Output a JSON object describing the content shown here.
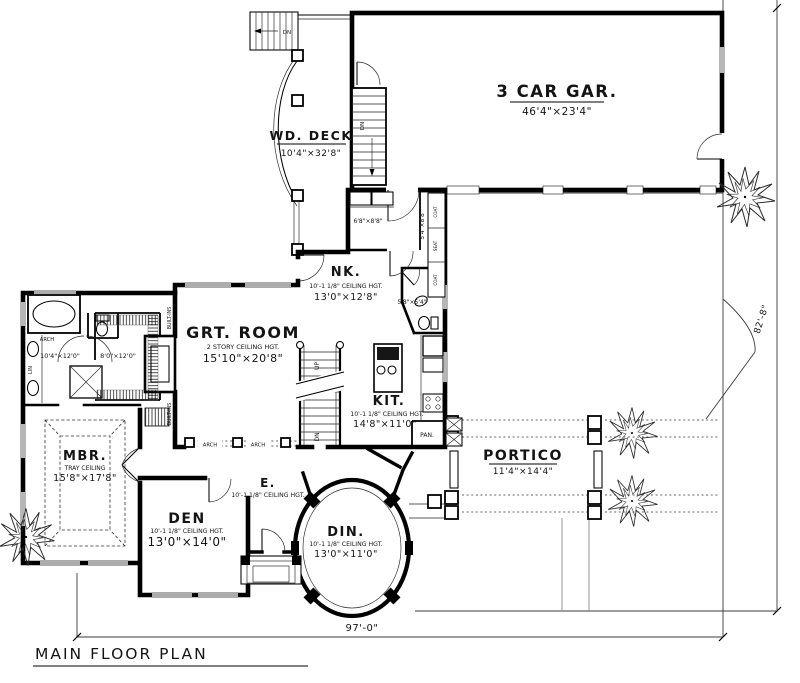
{
  "plan": {
    "title": "MAIN FLOOR PLAN"
  },
  "dimensions": {
    "width": "97'-0\"",
    "depth": "82'-8\""
  },
  "rooms": {
    "garage": {
      "name": "3 CAR GAR.",
      "size": "46'4\"×23'4\""
    },
    "deck": {
      "name": "WD. DECK",
      "size": "10'4\"×32'8\""
    },
    "nook": {
      "name": "NK.",
      "ceiling": "10'-1 1/8\" CEILING HGT.",
      "size": "13'0\"×12'8\""
    },
    "great_room": {
      "name": "GRT. ROOM",
      "ceiling": "2 STORY CEILING HGT.",
      "size": "15'10\"×20'8\""
    },
    "kitchen": {
      "name": "KIT.",
      "ceiling": "10'-1 1/8\" CEILING HGT.",
      "size": "14'8\"×11'0\""
    },
    "master_bedroom": {
      "name": "MBR.",
      "ceiling": "TRAY CEILING",
      "size": "15'8\"×17'8\""
    },
    "den": {
      "name": "DEN",
      "ceiling": "10'-1 1/8\" CEILING HGT.",
      "size": "13'0\"×14'0\""
    },
    "entry": {
      "name": "E.",
      "ceiling": "10'-1 1/8\" CEILING HGT."
    },
    "dining": {
      "name": "DIN.",
      "ceiling": "10'-1 1/8\" CEILING HGT.",
      "size": "13'0\"×11'0\""
    },
    "portico": {
      "name": "PORTICO",
      "size": "11'4\"×14'4\""
    },
    "master_bath": {
      "size": "10'4\"×12'0\""
    },
    "walk_in_closet": {
      "size": "8'0\"×12'0\""
    },
    "laundry": {
      "size": "6'8\"×8'8\""
    },
    "back_hall": {
      "size": "5'4\"×8'8\""
    },
    "powder": {
      "size": "5'8\"×5'4\""
    }
  },
  "annotations": {
    "arch": "ARCH",
    "built_ins": "BUILT-INS",
    "pantry": "PAN.",
    "linen": "LIN",
    "down": "DN",
    "up": "UP",
    "coat": "COAT",
    "seat": "SEAT"
  }
}
